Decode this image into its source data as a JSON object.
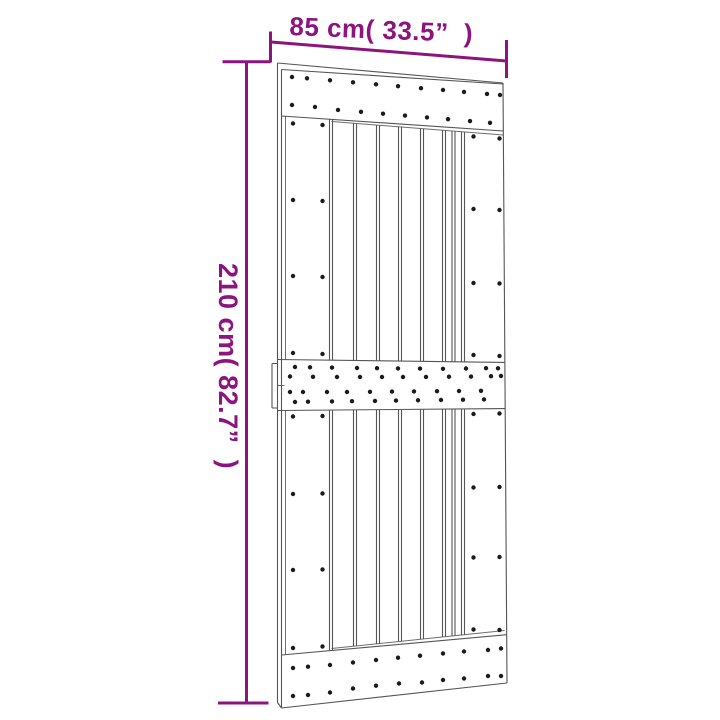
{
  "diagram": {
    "subject": "sliding barn door technical line drawing with nail dots",
    "width_dimension": {
      "label": "85 cm( 33.5”  )"
    },
    "height_dimension": {
      "label": "210 cm( 82.7”  )"
    }
  },
  "colors": {
    "dimension_accent": "#8c1480",
    "drawing_line": "#555555",
    "nail_dot": "#1b1b1b",
    "background": "#ffffff"
  }
}
